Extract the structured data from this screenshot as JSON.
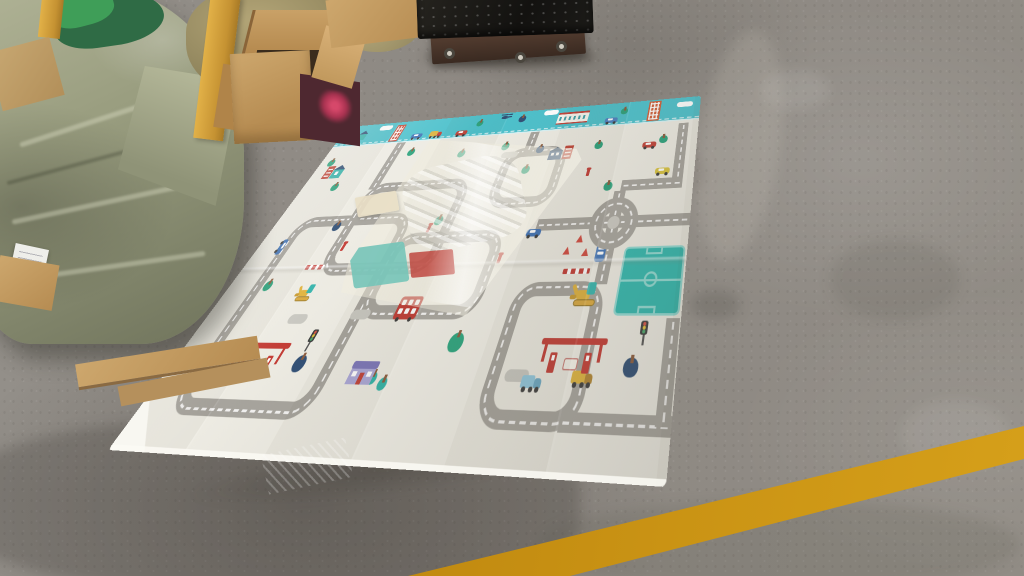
{
  "scene": {
    "type": "warehouse-photo",
    "description": "Children's city-road foldable play mat unrolled on a concrete warehouse floor; tarp-wrapped bundles and an open cardboard box at top-left; a black platform scale at top-center; a translucent plastic bag lying on the mat; a worn yellow painted line across the floor at bottom-right.",
    "visible_text": ""
  },
  "palette": {
    "floor": "#908b84",
    "floor_dark": "#6f6a61",
    "mat": "#edebe2",
    "band": "#4ac0cb",
    "road": "#a5a29b",
    "dash": "#ffffff",
    "red": "#c0392f",
    "tarp": "#999d80",
    "cardboard": "#c19a62",
    "box_maroon": "#4e2830",
    "strap": "#d9a83e",
    "scale_top": "#191816",
    "scale_base": "#4b332a",
    "yellow_line": "#cf9714",
    "tree_green": "#2aa17b",
    "tree_navy": "#2e4d73",
    "tree_teal": "#2fb3a6",
    "field": "#2fb7ad"
  },
  "objects": {
    "play_mat": "city road play mat",
    "bundles": "tarp-wrapped bundles",
    "box": "open cardboard box",
    "scale": "platform scale",
    "bag": "plastic packing bag",
    "line": "yellow floor line"
  },
  "mat": {
    "width": 560,
    "height": 360,
    "band_height": 36,
    "roads": {
      "loops": [
        {
          "x": 36,
          "y": 140,
          "w": 172,
          "h": 193
        },
        {
          "x": 113,
          "y": 98,
          "w": 155,
          "h": 112
        },
        {
          "x": 200,
          "y": 165,
          "w": 145,
          "h": 88
        },
        {
          "x": 300,
          "y": 60,
          "w": 90,
          "h": 80
        },
        {
          "x": 380,
          "y": 220,
          "w": 100,
          "h": 113
        }
      ],
      "segments": [
        {
          "x": 113,
          "y": 36,
          "w": 14,
          "h": 70
        },
        {
          "x": 325,
          "y": 36,
          "w": 13,
          "h": 30
        },
        {
          "x": 380,
          "y": 155,
          "w": 180,
          "h": 13
        },
        {
          "x": 466,
          "y": 126,
          "w": 14,
          "h": 97
        },
        {
          "x": 534,
          "y": 40,
          "w": 13,
          "h": 86
        },
        {
          "x": 473,
          "y": 113,
          "w": 74,
          "h": 13
        },
        {
          "x": 462,
          "y": 320,
          "w": 98,
          "h": 13
        },
        {
          "x": 546,
          "y": 252,
          "w": 13,
          "h": 75
        }
      ]
    },
    "band_items": [
      {
        "t": "tree",
        "x": 10,
        "y": 7,
        "s": 11,
        "c": "#2aa17b"
      },
      {
        "t": "house_t",
        "x": 34,
        "y": 15
      },
      {
        "t": "cloud",
        "x": 64,
        "y": 4
      },
      {
        "t": "bldg",
        "x": 94,
        "y": 5,
        "w": 15,
        "h": 28,
        "c": "#c14a38"
      },
      {
        "t": "car",
        "x": 130,
        "y": 23,
        "c": "#3f72b5"
      },
      {
        "t": "truck",
        "x": 160,
        "y": 21,
        "c": "#ddb23c",
        "c2": "#bf4036"
      },
      {
        "t": "car",
        "x": 204,
        "y": 24,
        "c": "#bf4036"
      },
      {
        "t": "tree",
        "x": 236,
        "y": 9,
        "s": 10,
        "c": "#2aa17b"
      },
      {
        "t": "heli",
        "x": 266,
        "y": 2
      },
      {
        "t": "tree",
        "x": 302,
        "y": 7,
        "s": 11,
        "c": "#2e4d73"
      },
      {
        "t": "cloud",
        "x": 334,
        "y": 2
      },
      {
        "t": "station",
        "x": 358,
        "y": 11
      },
      {
        "t": "car",
        "x": 430,
        "y": 23,
        "c": "#4a7fc1"
      },
      {
        "t": "tree",
        "x": 455,
        "y": 9,
        "s": 10,
        "c": "#2aa17b"
      },
      {
        "t": "bldg",
        "x": 489,
        "y": 2,
        "w": 17,
        "h": 31,
        "c": "#cf5c36"
      },
      {
        "t": "cloud",
        "x": 528,
        "y": 7
      }
    ],
    "items": [
      {
        "t": "tree",
        "x": 18,
        "y": 56,
        "s": 11,
        "c": "#2aa17b"
      },
      {
        "t": "tree",
        "x": 54,
        "y": 94,
        "s": 11,
        "c": "#2aa17b"
      },
      {
        "t": "tree",
        "x": 146,
        "y": 48,
        "s": 11,
        "c": "#2aa17b"
      },
      {
        "t": "tree",
        "x": 230,
        "y": 56,
        "s": 11,
        "c": "#2aa17b"
      },
      {
        "t": "tree",
        "x": 294,
        "y": 50,
        "s": 11,
        "c": "#2aa17b"
      },
      {
        "t": "tree",
        "x": 338,
        "y": 86,
        "s": 11,
        "c": "#2aa17b"
      },
      {
        "t": "tree",
        "x": 430,
        "y": 58,
        "s": 11,
        "c": "#2aa17b"
      },
      {
        "t": "tree",
        "x": 516,
        "y": 56,
        "s": 11,
        "c": "#2aa17b"
      },
      {
        "t": "tree",
        "x": 246,
        "y": 146,
        "s": 11,
        "c": "#2aa17b"
      },
      {
        "t": "tree",
        "x": 56,
        "y": 214,
        "s": 11,
        "c": "#2aa17b"
      },
      {
        "t": "tree",
        "x": 456,
        "y": 114,
        "s": 11,
        "c": "#2aa17b"
      },
      {
        "t": "tree",
        "x": 334,
        "y": 264,
        "s": 16,
        "c": "#2aa17b"
      },
      {
        "t": "tree",
        "x": 348,
        "y": 58,
        "s": 11,
        "c": "#2e4d73"
      },
      {
        "t": "tree",
        "x": 100,
        "y": 148,
        "s": 11,
        "c": "#2e4d73"
      },
      {
        "t": "tree",
        "x": 164,
        "y": 284,
        "s": 14,
        "c": "#2e4d73"
      },
      {
        "t": "tree",
        "x": 518,
        "y": 282,
        "s": 14,
        "c": "#2e4d73"
      },
      {
        "t": "tree",
        "x": 258,
        "y": 296,
        "s": 10,
        "c": "#2fb3a6"
      },
      {
        "t": "tree",
        "x": 272,
        "y": 300,
        "s": 10,
        "c": "#2fb3a6"
      },
      {
        "t": "cloudg",
        "x": 294,
        "y": 64
      },
      {
        "t": "cloudg",
        "x": 398,
        "y": 292
      },
      {
        "t": "cloudg",
        "x": 194,
        "y": 244
      },
      {
        "t": "cloudg",
        "x": 116,
        "y": 248
      },
      {
        "t": "pair_teal",
        "x": 20,
        "y": 58
      },
      {
        "t": "pair_blue",
        "x": 364,
        "y": 60
      },
      {
        "t": "house_p",
        "x": 230,
        "y": 288
      },
      {
        "t": "bus2",
        "x": 248,
        "y": 232
      },
      {
        "t": "car",
        "x": 27,
        "y": 172,
        "c": "#3f72b5",
        "r": 90
      },
      {
        "t": "car",
        "x": 370,
        "y": 166,
        "c": "#3f72b5"
      },
      {
        "t": "car",
        "x": 512,
        "y": 100,
        "c": "#d8c23c"
      },
      {
        "t": "car",
        "x": 490,
        "y": 64,
        "c": "#bf4036"
      },
      {
        "t": "car",
        "x": 104,
        "y": 292,
        "c": "#d8c23c"
      },
      {
        "t": "car",
        "x": 60,
        "y": 298,
        "c": "#8fc7de"
      },
      {
        "t": "truck",
        "x": 464,
        "y": 292,
        "c": "#ddb23c",
        "c2": "#b08430"
      },
      {
        "t": "truck",
        "x": 416,
        "y": 296,
        "c": "#8fc7de",
        "c2": "#6aa8c4"
      },
      {
        "t": "bus_s",
        "x": 460,
        "y": 184,
        "c": "#3f72b5"
      },
      {
        "t": "excv",
        "x": 446,
        "y": 220,
        "s": 1
      },
      {
        "t": "excv",
        "x": 106,
        "y": 218,
        "s": 0.8
      },
      {
        "t": "gas",
        "x": 74,
        "y": 274
      },
      {
        "t": "gas",
        "x": 426,
        "y": 268
      },
      {
        "t": "field",
        "x": 492,
        "y": 188,
        "w": 66,
        "h": 62
      },
      {
        "t": "round",
        "x": 445,
        "y": 134,
        "s": 56
      },
      {
        "t": "tlight",
        "x": 522,
        "y": 254
      },
      {
        "t": "tlight",
        "x": 158,
        "y": 262
      },
      {
        "t": "cone",
        "x": 434,
        "y": 174
      },
      {
        "t": "cone",
        "x": 444,
        "y": 188
      },
      {
        "t": "cone",
        "x": 422,
        "y": 186
      },
      {
        "t": "fence",
        "x": 428,
        "y": 208,
        "w": 30
      },
      {
        "t": "fence",
        "x": 94,
        "y": 198,
        "w": 26
      },
      {
        "t": "marker",
        "x": 128,
        "y": 174
      },
      {
        "t": "marker",
        "x": 346,
        "y": 192
      },
      {
        "t": "marker",
        "x": 424,
        "y": 96
      },
      {
        "t": "marker",
        "x": 236,
        "y": 156
      }
    ]
  }
}
